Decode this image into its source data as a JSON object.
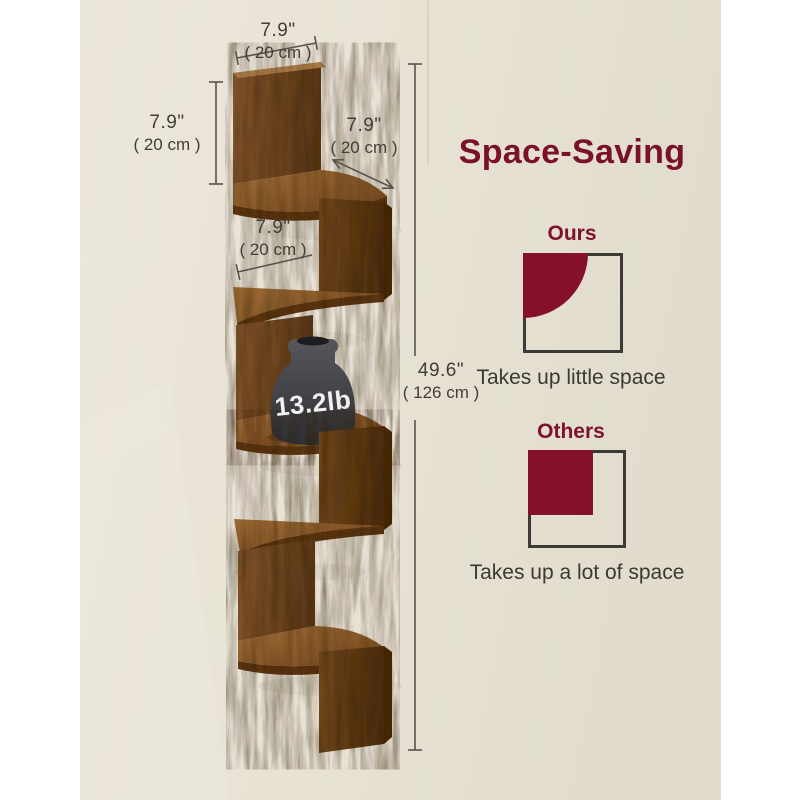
{
  "photo": {
    "wall_color": "#e7e2d4",
    "weight_label": "13.2lb"
  },
  "dimensions": {
    "top_width": {
      "inches": "7.9\"",
      "cm": "( 20 cm )"
    },
    "left_height": {
      "inches": "7.9\"",
      "cm": "( 20 cm )"
    },
    "right_depth": {
      "inches": "7.9\"",
      "cm": "( 20 cm )"
    },
    "middle_width": {
      "inches": "7.9\"",
      "cm": "( 20 cm )"
    },
    "total_height": {
      "inches": "49.6\"",
      "cm": "( 126 cm )"
    }
  },
  "info_panel": {
    "title": "Space-Saving",
    "ours": {
      "label": "Ours",
      "caption": "Takes up little space",
      "icon": "quarter-circle-in-square-icon"
    },
    "others": {
      "label": "Others",
      "caption": "Takes up a lot of space",
      "icon": "filled-square-in-square-icon"
    }
  },
  "colors": {
    "accent_maroon": "#7f112b",
    "text_dark": "#3b3934",
    "dimension_line": "#57544c",
    "wood_brown": "#7c4f24",
    "vase_gray": "#3f4045",
    "wall_beige": "#e7e2d4"
  }
}
